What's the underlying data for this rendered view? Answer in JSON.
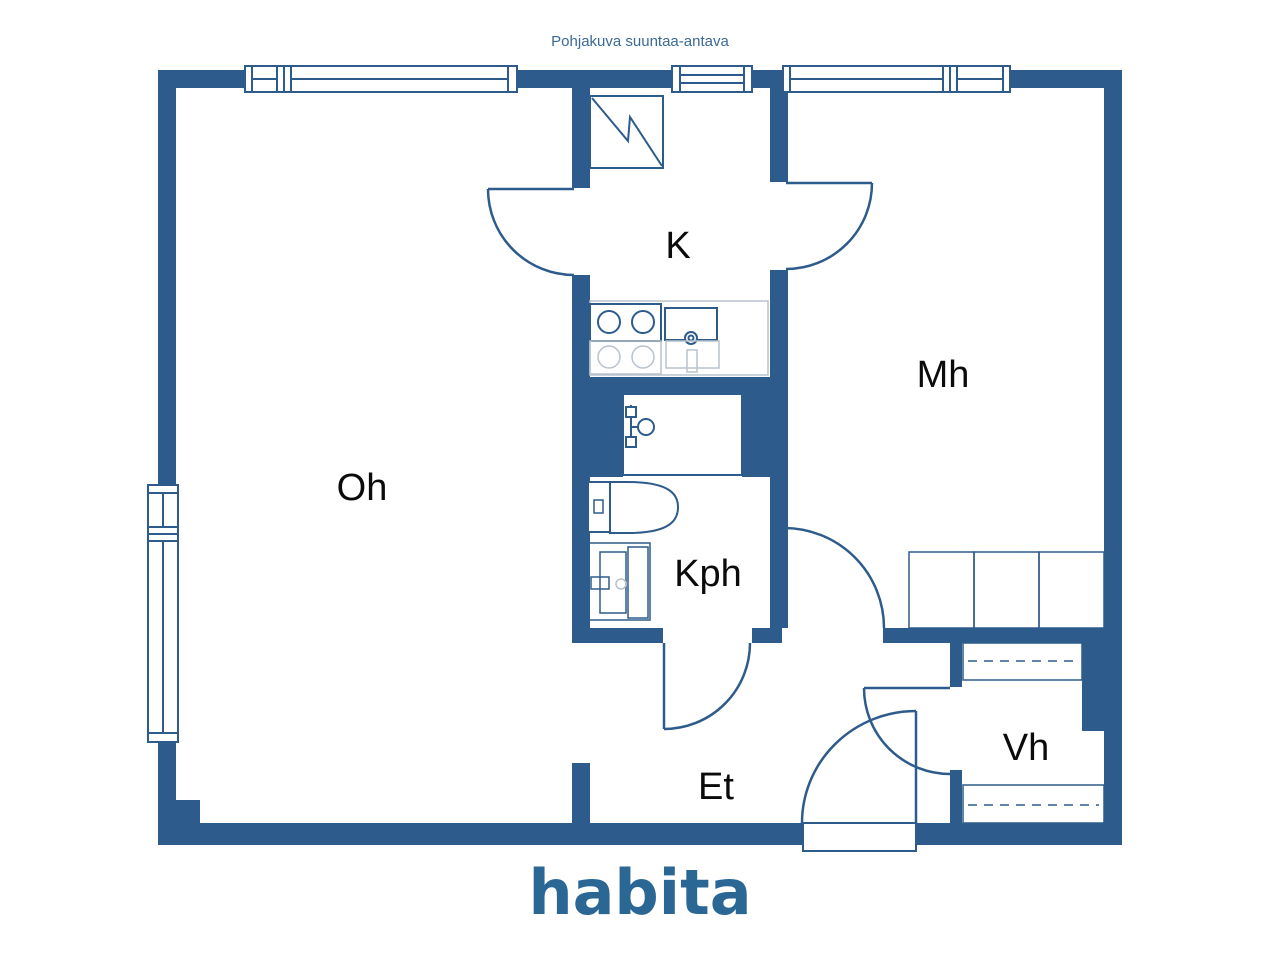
{
  "header": {
    "note": "Pohjakuva suuntaa-antava"
  },
  "logo": {
    "text": "habita"
  },
  "colors": {
    "wall": "#2d5c8c",
    "room_label": "#0b0b0b",
    "light_fixture": "#b9c2cc",
    "header_text": "#3a6a96",
    "logo_blue": "#2b6795",
    "background": "#ffffff"
  },
  "rooms": {
    "k": {
      "label": "K"
    },
    "mh": {
      "label": "Mh"
    },
    "oh": {
      "label": "Oh"
    },
    "kph": {
      "label": "Kph"
    },
    "et": {
      "label": "Et"
    },
    "vh": {
      "label": "Vh"
    }
  },
  "icons": [
    "fridge-icon",
    "stove-icon",
    "sink-icon",
    "shower-mixer-icon",
    "toilet-icon",
    "washbasin-icon",
    "wardrobe",
    "closet-shelf"
  ]
}
